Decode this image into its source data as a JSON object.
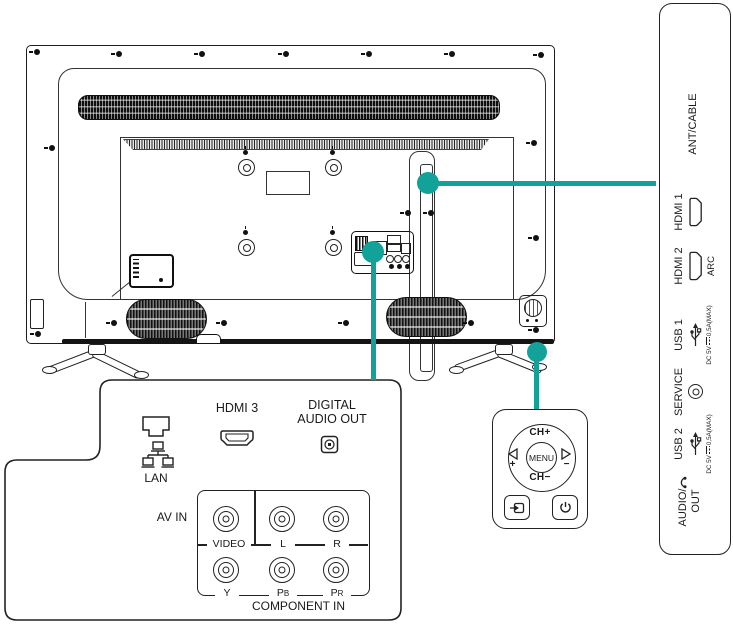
{
  "colors": {
    "accent": "#12A29A",
    "line": "#1a1a1a"
  },
  "right_panel": {
    "ports": [
      {
        "label": "ANT/CABLE"
      },
      {
        "label": "HDMI 1"
      },
      {
        "label": "HDMI 2",
        "sub": "ARC"
      },
      {
        "label": "USB 1",
        "dc_prefix": "DC 5V",
        "dc_suffix": "0,5A(MAX)"
      },
      {
        "label": "SERVICE"
      },
      {
        "label": "USB 2",
        "dc_prefix": "DC 5V",
        "dc_suffix": "0,5A(MAX)"
      },
      {
        "label_line1": "AUDIO/",
        "label_line2": "OUT"
      }
    ]
  },
  "bottom_callout": {
    "lan": "LAN",
    "hdmi3": "HDMI 3",
    "digital_line1": "DIGITAL",
    "digital_line2": "AUDIO OUT",
    "av_in": "AV IN",
    "component_in": "COMPONENT IN",
    "video": "VIDEO",
    "left": "L",
    "right": "R",
    "y": "Y",
    "pb": "P",
    "pb_sub": "B",
    "pr": "P",
    "pr_sub": "R"
  },
  "control_pad": {
    "ch_up": "CH+",
    "ch_down": "CH−",
    "menu": "MENU",
    "vol_up": "+",
    "vol_down": "−"
  }
}
